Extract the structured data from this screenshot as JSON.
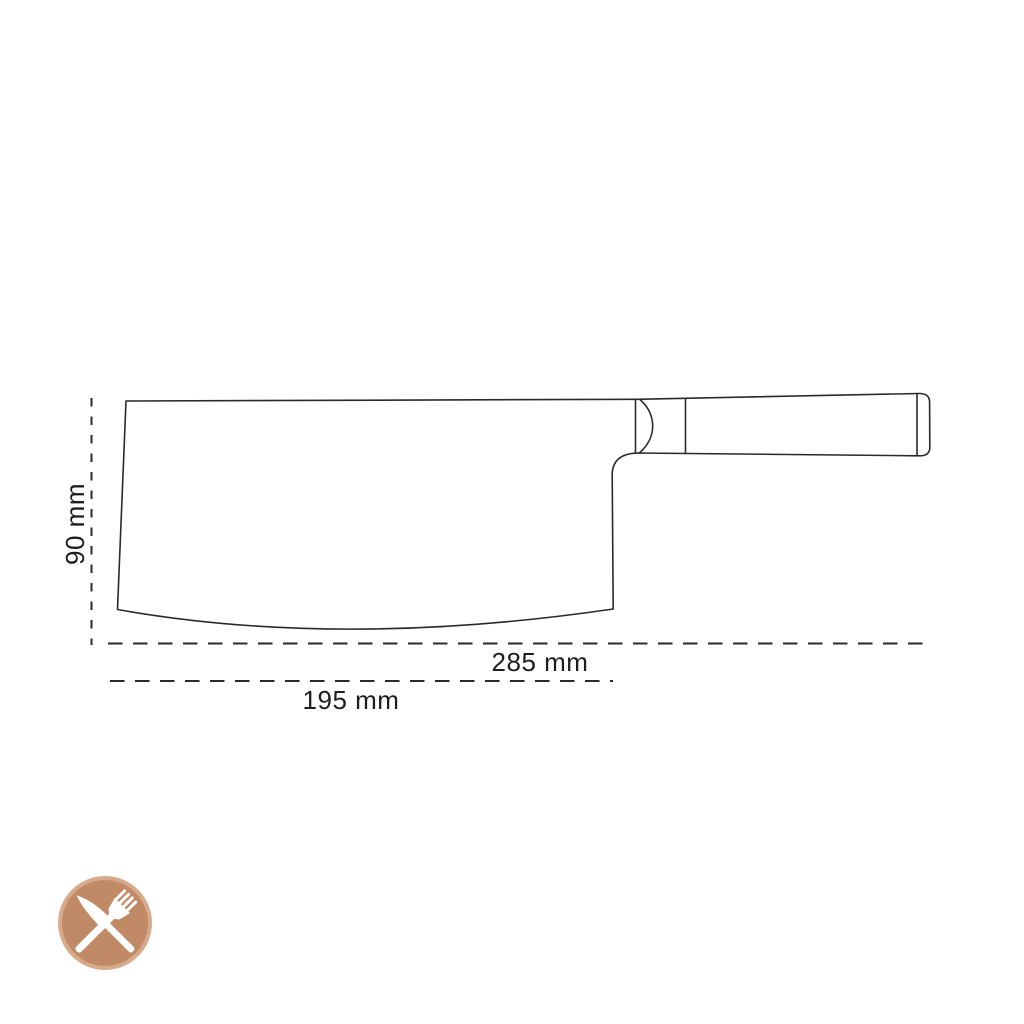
{
  "diagram": {
    "line_color": "#2b2a29",
    "text_color": "#1d1d1b",
    "labels": {
      "height": "90 mm",
      "total_length": "285 mm",
      "blade_length": "195 mm"
    }
  },
  "logo": {
    "icon": "crossed-knife-and-fork-icon",
    "ring_color": "#d7aa8c",
    "fill_color": "#c18a67",
    "glyph_color": "#ffffff"
  }
}
